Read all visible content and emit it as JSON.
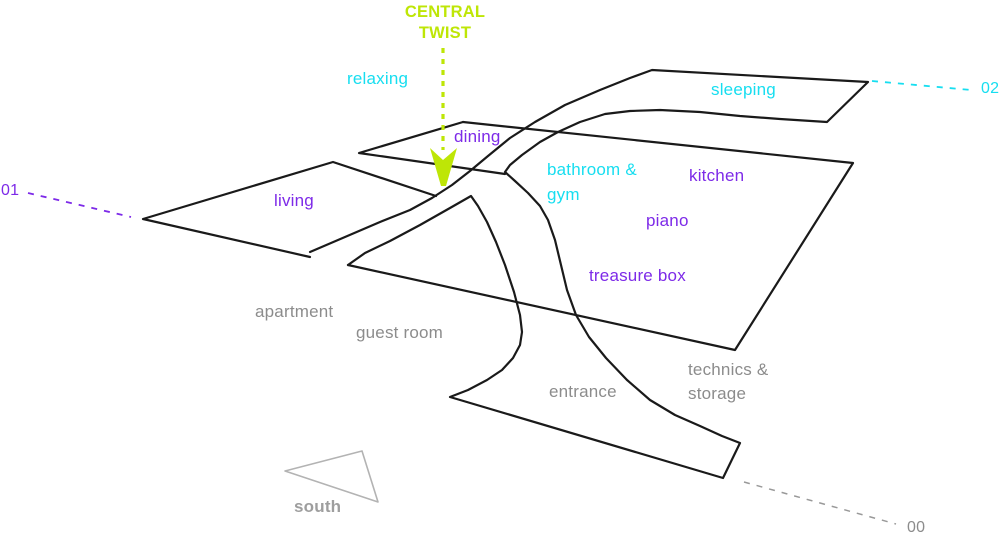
{
  "diagram": {
    "title": "CENTRAL\nTWIST",
    "rooms": {
      "relaxing": "relaxing",
      "sleeping": "sleeping",
      "dining": "dining",
      "living": "living",
      "bathroom_gym": "bathroom &\ngym",
      "kitchen": "kitchen",
      "piano": "piano",
      "treasure_box": "treasure box",
      "apartment": "apartment",
      "guest_room": "guest room",
      "entrance": "entrance",
      "technics_storage": "technics &\nstorage"
    },
    "levels": {
      "l02": "02",
      "l01": "01",
      "l00": "00"
    },
    "compass": {
      "south": "south"
    },
    "colors": {
      "level01_accent": "#7D2AE8",
      "level02_accent": "#17DEF0",
      "level00_accent": "#8C8C8C",
      "twist_accent": "#BEE606",
      "outline": "#1A1A1A",
      "compass_gray": "#B3B3B3"
    }
  }
}
